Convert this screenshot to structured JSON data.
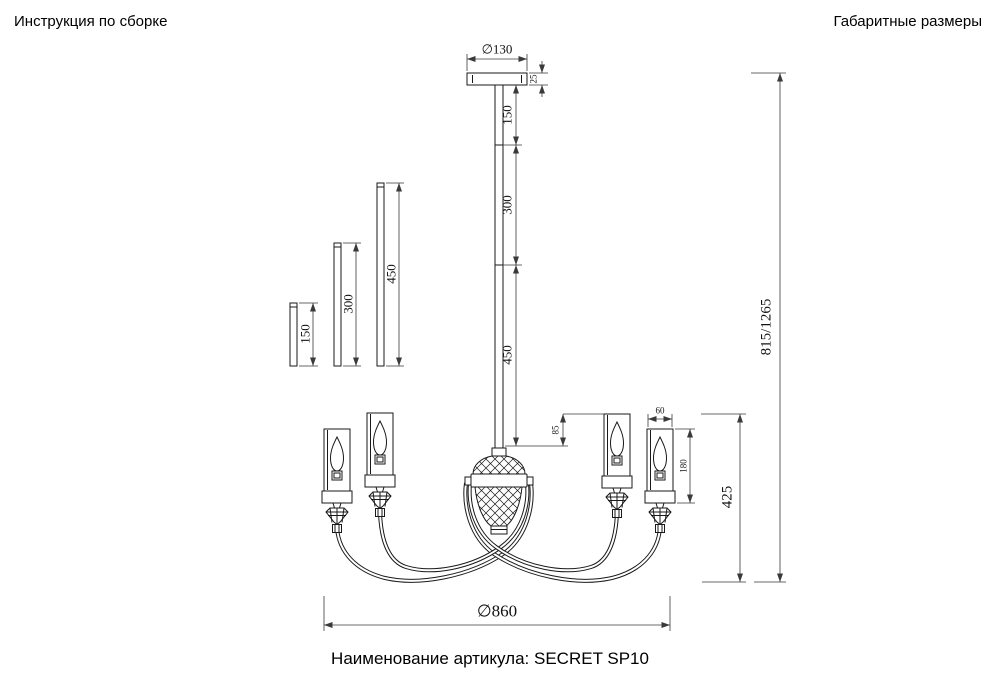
{
  "header": {
    "instructions_title": "Инструкция по сборке",
    "dimensions_title": "Габаритные размеры"
  },
  "footer": {
    "article_name": "Наименование артикула: SECRET SP10"
  },
  "dimensions": {
    "canopy_diameter": "∅130",
    "canopy_thickness": "25",
    "rod_segment_top": "150",
    "rod_segment_middle": "300",
    "rod_segment_bottom": "450",
    "spare_rod_short": "150",
    "spare_rod_medium": "300",
    "spare_rod_long": "450",
    "shade_top_offset": "85",
    "shade_width": "60",
    "shade_height": "180",
    "height_range": "815/1265",
    "body_height": "425",
    "overall_diameter": "∅860"
  },
  "colors": {
    "line": "#1a1a1a",
    "dimension": "#3a3a3a",
    "background": "#ffffff"
  }
}
